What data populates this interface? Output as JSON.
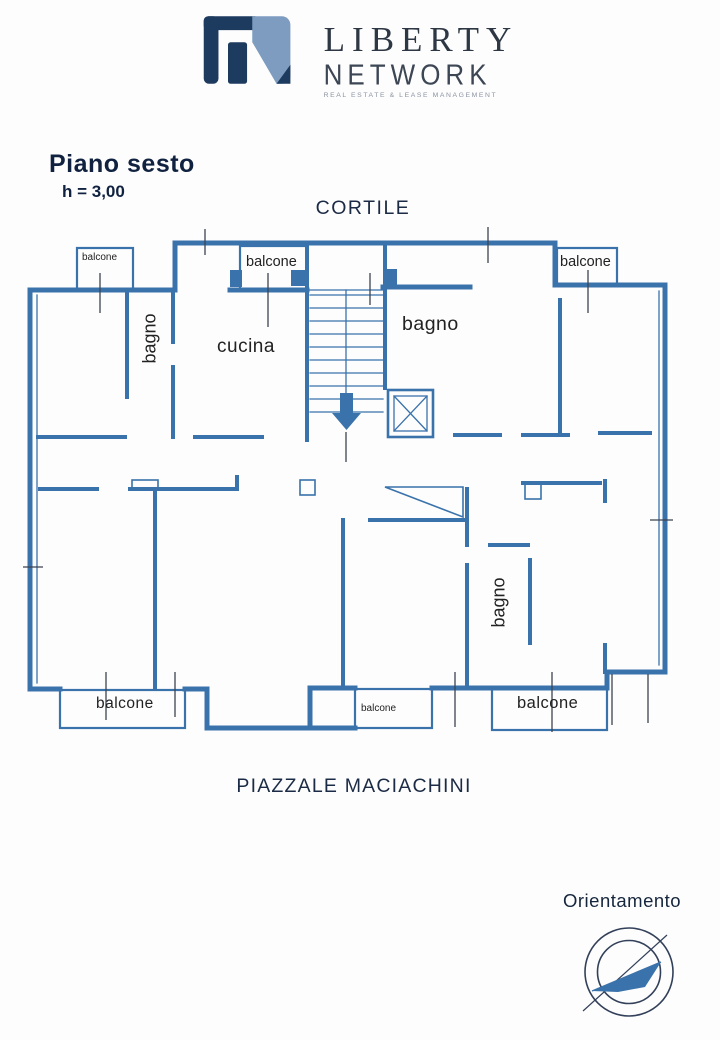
{
  "logo": {
    "title": "LIBERTY",
    "subtitle": "NETWORK",
    "tagline": "REAL ESTATE & LEASE MANAGEMENT"
  },
  "header": {
    "floor_title": "Piano sesto",
    "height_note": "h = 3,00"
  },
  "plan": {
    "top_label": "CORTILE",
    "bottom_label": "PIAZZALE MACIACHINI",
    "rooms": [
      {
        "id": "bagno-left",
        "label": "bagno",
        "orientation": "vertical"
      },
      {
        "id": "cucina",
        "label": "cucina",
        "orientation": "horizontal"
      },
      {
        "id": "bagno-top-right",
        "label": "bagno",
        "orientation": "horizontal"
      },
      {
        "id": "bagno-bottom",
        "label": "bagno",
        "orientation": "vertical"
      }
    ],
    "balconies": [
      {
        "id": "top-left",
        "label": "balcone"
      },
      {
        "id": "top-center",
        "label": "balcone"
      },
      {
        "id": "top-right",
        "label": "balcone"
      },
      {
        "id": "bottom-left",
        "label": "balcone"
      },
      {
        "id": "bottom-center",
        "label": "balcone"
      },
      {
        "id": "bottom-right",
        "label": "balcone"
      }
    ]
  },
  "compass": {
    "label": "Orientamento"
  },
  "colors": {
    "wall_blue": "#3a72ab",
    "ink_navy": "#1c2b45",
    "logo_dark": "#1d3a5f",
    "logo_light": "#7d9cc0"
  }
}
